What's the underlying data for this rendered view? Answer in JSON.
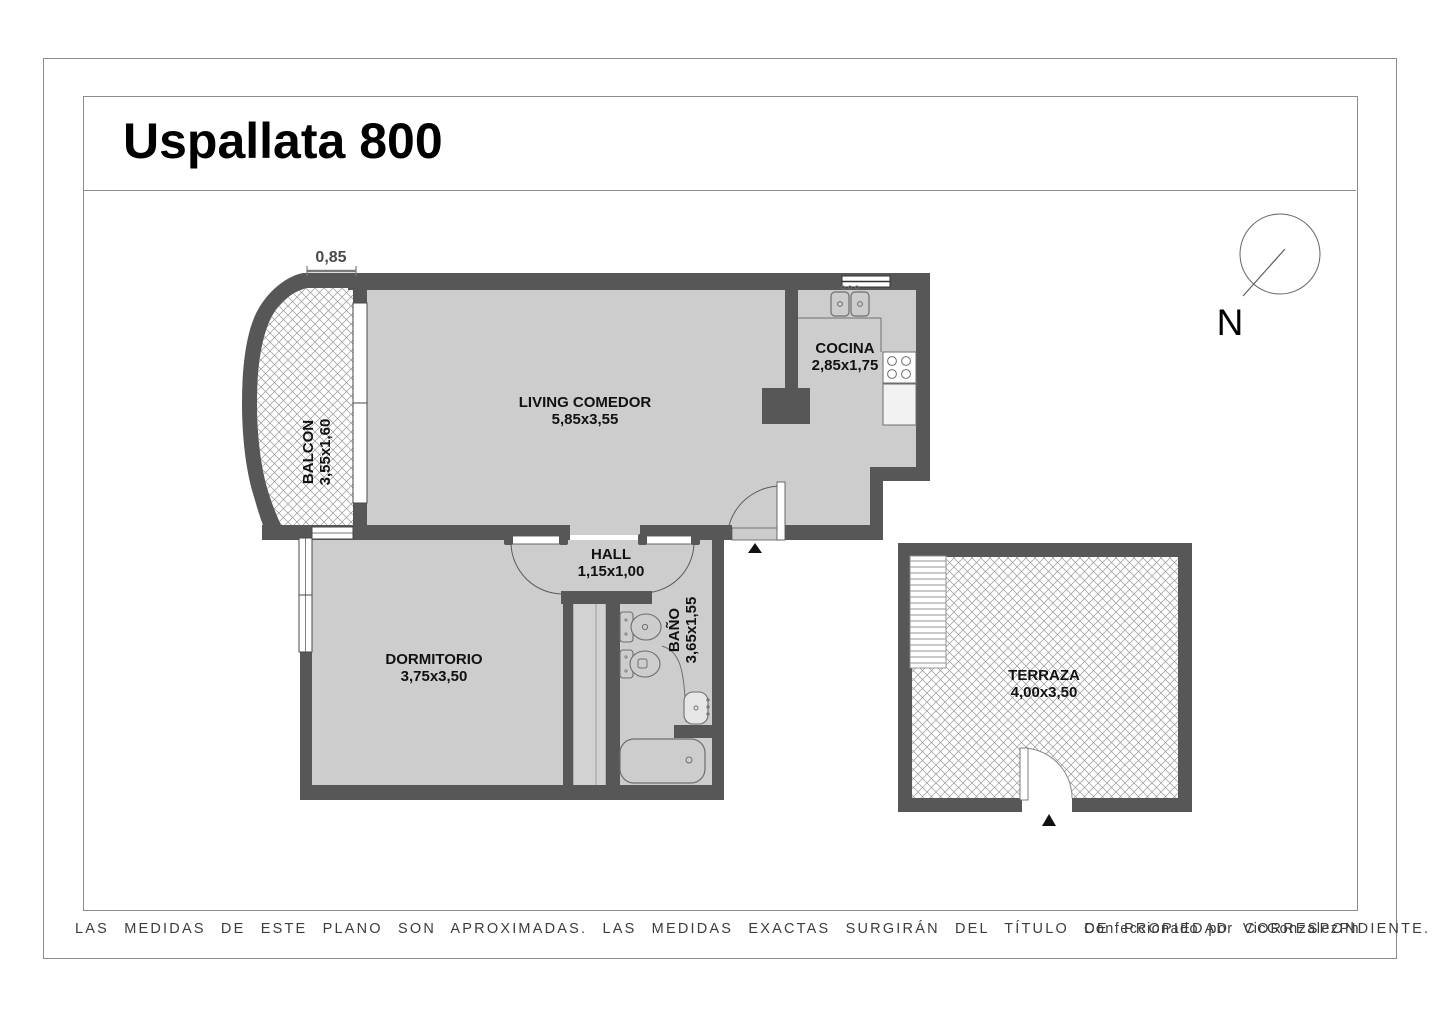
{
  "page": {
    "title": "Uspallata 800"
  },
  "north": {
    "label": "N"
  },
  "dimensions": {
    "balcony_top": "0,85"
  },
  "rooms": {
    "balcon": {
      "name": "BALCON",
      "size": "3,55x1,60"
    },
    "living": {
      "name": "LIVING COMEDOR",
      "size": "5,85x3,55"
    },
    "cocina": {
      "name": "COCINA",
      "size": "2,85x1,75"
    },
    "hall": {
      "name": "HALL",
      "size": "1,15x1,00"
    },
    "bano": {
      "name": "BAÑO",
      "size": "3,65x1,55"
    },
    "dormitorio": {
      "name": "DORMITORIO",
      "size": "3,75x3,50"
    },
    "terraza": {
      "name": "TERRAZA",
      "size": "4,00x3,50"
    }
  },
  "footer": {
    "disclaimer": "LAS MEDIDAS DE ESTE PLANO SON APROXIMADAS. LAS MEDIDAS EXACTAS SURGIRÁN DEL TÍTULO DE PROPIEDAD CORRESPONDIENTE.",
    "credit": "Confeccionado por VicGonzalezPh"
  },
  "colors": {
    "wall": "#575757",
    "floor": "#cdcdcd",
    "hatch_line": "#979797",
    "fixture_line": "#6e6e6e",
    "entrance_marker": "#111111"
  }
}
